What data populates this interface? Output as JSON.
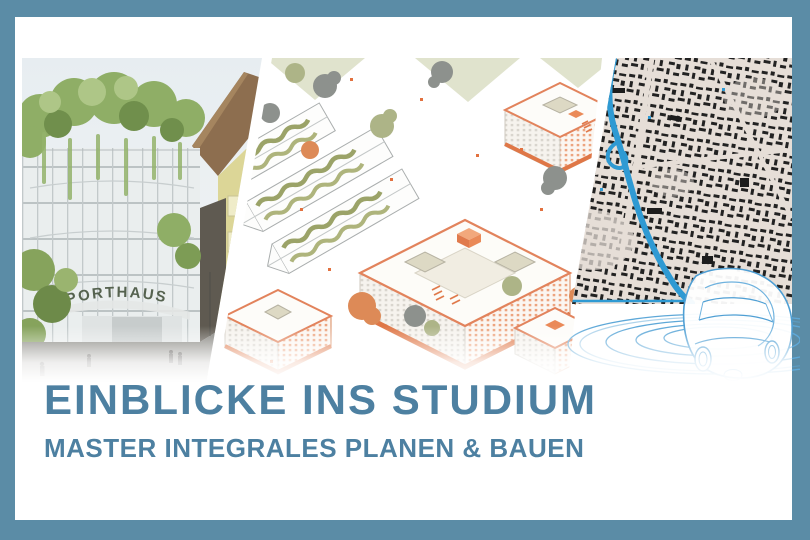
{
  "banner": {
    "title": "EINBLICKE INS STUDIUM",
    "subtitle": "MASTER INTEGRALES PLANEN & BAUEN"
  },
  "panels": {
    "rendering": {
      "sign_text": "SPORTHAUS"
    }
  },
  "colors": {
    "frame_blue": "#5b8ca6",
    "heading_blue": "#4d80a1",
    "river_blue": "#2f9ad3",
    "car_line_blue": "#5ea8d8",
    "accent_orange": "#e2835c",
    "map_beige": "#e6ded7"
  }
}
